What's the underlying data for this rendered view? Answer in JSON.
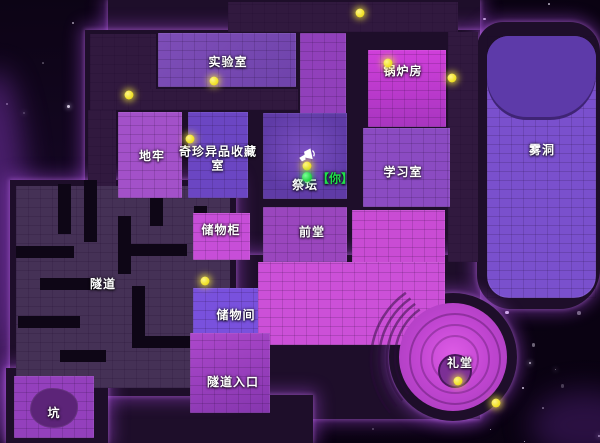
{
  "scene": {
    "description": "top-down haunted mansion game map, night starfield background",
    "colors": {
      "background": "#0b0313",
      "mansion_walls": "#1e0e2a",
      "glow_accent": "#b050e8",
      "room_bright_magenta": "#cc50d8",
      "room_violet": "#7c4bb5",
      "room_blue_violet": "#6b46c3",
      "orb_yellow": "#f2e32f",
      "player_green": "#27d847",
      "label_text": "#ffffff"
    }
  },
  "rooms": [
    {
      "id": "lab",
      "label": "实验室"
    },
    {
      "id": "boiler-room",
      "label": "锅炉房"
    },
    {
      "id": "fog-cave",
      "label": "雾洞"
    },
    {
      "id": "dungeon",
      "label": "地牢"
    },
    {
      "id": "curiosities-room",
      "label": "奇珍异品收藏室"
    },
    {
      "id": "altar",
      "label": "祭坛"
    },
    {
      "id": "study-room",
      "label": "学习室"
    },
    {
      "id": "lockers",
      "label": "储物柜"
    },
    {
      "id": "front-hall",
      "label": "前堂"
    },
    {
      "id": "storage-room",
      "label": "储物间"
    },
    {
      "id": "tunnel",
      "label": "隧道"
    },
    {
      "id": "tunnel-entrance",
      "label": "隧道入口"
    },
    {
      "id": "pit",
      "label": "坑"
    },
    {
      "id": "chapel",
      "label": "礼堂"
    }
  ],
  "player": {
    "tag": "【你】",
    "room": "祭坛",
    "color": "#1fe04a"
  },
  "markers": {
    "orb_color": "#f2e32f",
    "orbs": [
      {
        "x": 360,
        "y": 13
      },
      {
        "x": 129,
        "y": 95
      },
      {
        "x": 214,
        "y": 81
      },
      {
        "x": 190,
        "y": 139
      },
      {
        "x": 388,
        "y": 63
      },
      {
        "x": 452,
        "y": 78
      },
      {
        "x": 307,
        "y": 166
      },
      {
        "x": 205,
        "y": 281
      },
      {
        "x": 458,
        "y": 381
      },
      {
        "x": 496,
        "y": 403
      }
    ]
  },
  "icons": [
    {
      "name": "announcement-speaker-icon",
      "location": "altar"
    }
  ]
}
